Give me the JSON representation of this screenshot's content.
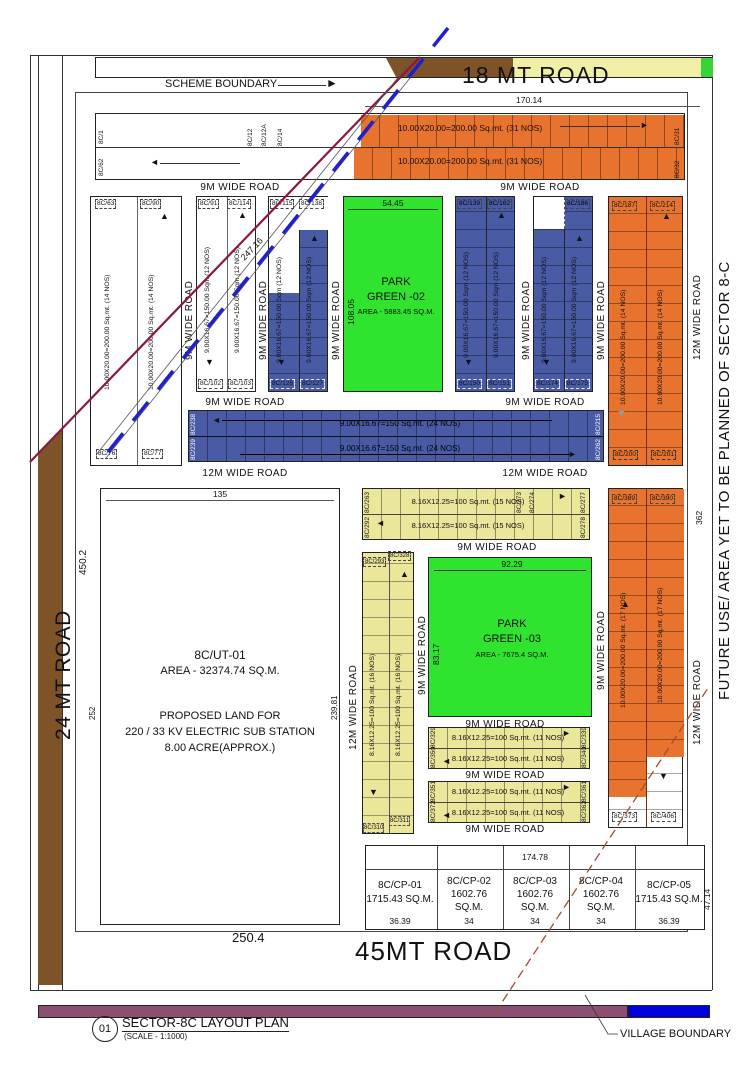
{
  "notes": {
    "scheme": "SCHEME BOUNDARY",
    "village": "VILLAGE BOUNDARY",
    "future": "FUTURE USE/ AREA YET TO BE PLANNED OF SECTOR 8-C"
  },
  "roads": {
    "mt18": "18 MT ROAD",
    "mt24": "24 MT ROAD",
    "mt45": "45MT ROAD",
    "w9": "9M WIDE ROAD",
    "w12": "12M WIDE ROAD"
  },
  "specs": {
    "s31": "10.00X20.00=200.00 Sq.mt. (31 NOS)",
    "s14": "10.00X20.00=200.00 Sq.mt. (14 NOS)",
    "s17": "10.00X20.00=200.00 Sq.mt. (17 NOS)",
    "s12": "9.00X16.67=150.00 Sqm (12 NOS)",
    "s24": "9.00X16.67=150 Sq.mt. (24 NOS)",
    "s15": "8.16X12.25=100 Sq.mt. (15 NOS)",
    "s16": "8.16X12.25=100 Sq.mt. (16 NOS)",
    "s11": "8.16X12.25=100 Sq.mt. (11 NOS)"
  },
  "plots": {
    "p1": "8C/1",
    "p12": "8C/12",
    "p12A": "8C/12A",
    "p14": "8C/14",
    "p31": "8C/31",
    "p32": "8C/32",
    "p62": "8C/62",
    "p63": "8C/63",
    "p76": "8C/76",
    "p77": "8C/77",
    "p90": "8C/90",
    "p91": "8C/91",
    "p102": "8C/102",
    "p103": "8C/103",
    "p114": "8C/114",
    "p115": "8C/115",
    "p126": "8C/126",
    "p127": "8C/127",
    "p138": "8C/138",
    "p139": "8C/139",
    "p150": "8C/150",
    "p151": "8C/151",
    "p162": "8C/162",
    "p174": "8C/174",
    "p175": "8C/175",
    "p186": "8C/186",
    "p187": "8C/187",
    "p200": "8C/200",
    "p201": "8C/201",
    "p214": "8C/214",
    "p215": "8C/215",
    "p238": "8C/238",
    "p239": "8C/239",
    "p262": "8C/262",
    "p263": "8C/263",
    "p273": "8C/273",
    "p274": "8C/274",
    "p277": "8C/277",
    "p278": "8C/278",
    "p292": "8C/292",
    "p293": "8C/293",
    "p310": "8C/310",
    "p311": "8C/311",
    "p328": "8C/328",
    "p329": "8C/329",
    "p339": "8C/339",
    "p340": "8C/340",
    "p350": "8C/350",
    "p351": "8C/351",
    "p361": "8C/361",
    "p362": "8C/362",
    "p372": "8C/372",
    "p373": "8C/373",
    "p389": "8C/389",
    "p390": "8C/390",
    "p406": "8C/406"
  },
  "parks": {
    "p2": {
      "l1": "PARK",
      "l2": "GREEN -02",
      "l3": "AREA - 5883.45 SQ.M.",
      "w": "54.45",
      "h": "108.05"
    },
    "p3": {
      "l1": "PARK",
      "l2": "GREEN -03",
      "l3": "AREA - 7675.4 SQ.M.",
      "w": "92.29",
      "h": "83.17"
    }
  },
  "ut": {
    "id": "8C/UT-01",
    "area": "AREA - 32374.74 SQ.M.",
    "l1": "PROPOSED LAND FOR",
    "l2": "220 / 33 KV ELECTRIC SUB STATION",
    "l3": "8.00 ACRE(APPROX.)",
    "dim_w": "135",
    "dim_h": "239.81",
    "dim_left": "252",
    "dim_450": "450.2"
  },
  "dims": {
    "d170": "170.14",
    "d247": "247.16",
    "d362": "362",
    "d174": "174.78",
    "d47": "47.14",
    "d250": "250.4"
  },
  "cp": {
    "cells": [
      {
        "name": "8C/CP-01",
        "line1": "1715.43 SQ.M.",
        "line2": "",
        "w": "36.39"
      },
      {
        "name": "8C/CP-02",
        "line1": "1602.76",
        "line2": "SQ.M.",
        "w": "34"
      },
      {
        "name": "8C/CP-03",
        "line1": "1602.76",
        "line2": "SQ.M.",
        "w": "34"
      },
      {
        "name": "8C/CP-04",
        "line1": "1602.76",
        "line2": "SQ.M.",
        "w": "34"
      },
      {
        "name": "8C/CP-05",
        "line1": "1715.43 SQ.M.",
        "line2": "",
        "w": "36.39"
      }
    ]
  },
  "footer": {
    "num": "01",
    "title": "SECTOR-8C LAYOUT PLAN",
    "scale": "(SCALE - 1:1000)"
  },
  "colors": {
    "orange": "#E8732E",
    "blue": "#4A5BA6",
    "green": "#2FE32F",
    "yellow": "#EAE69A",
    "brown": "#7D5327",
    "purple": "#8C4E73",
    "bar_blue": "#0000DD",
    "maroon": "#8B1A3A",
    "boundary_blue": "#2020CC"
  }
}
